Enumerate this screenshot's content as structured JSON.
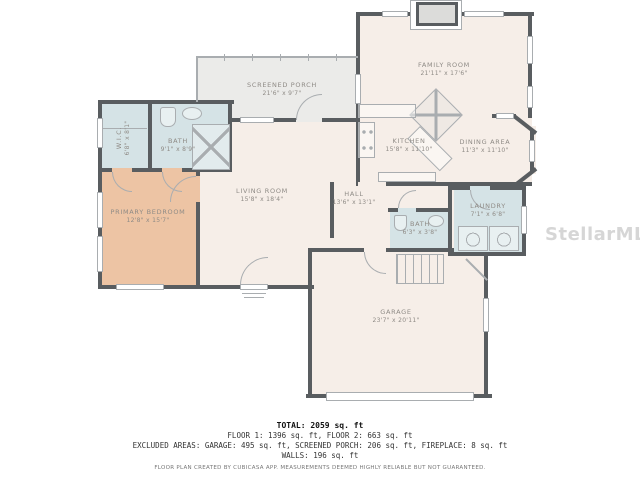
{
  "watermark": "StellarMLS",
  "colors": {
    "wall": "#595d60",
    "floor": "#f6eee8",
    "porch": "#ebebe9",
    "wet": "#d5e3e6",
    "bedroom": "#edc4a4",
    "label": "#8f8b86",
    "line": "#a9adb0",
    "ftext": "#333333",
    "wm": "#cccccc"
  },
  "rooms": {
    "family": {
      "name": "FAMILY ROOM",
      "dims": "21'11\" x 17'6\""
    },
    "porch": {
      "name": "SCREENED PORCH",
      "dims": "21'6\" x 9'7\""
    },
    "kitchen": {
      "name": "KITCHEN",
      "dims": "15'8\" x 11'10\""
    },
    "dining": {
      "name": "DINING AREA",
      "dims": "11'3\" x 11'10\""
    },
    "wic": {
      "name": "W.I.C.",
      "dims": "6'8\" x 8'1\""
    },
    "bath1": {
      "name": "BATH",
      "dims": "9'1\" x 8'9\""
    },
    "bedroom": {
      "name": "PRIMARY BEDROOM",
      "dims": "12'8\" x 15'7\""
    },
    "living": {
      "name": "LIVING ROOM",
      "dims": "15'8\" x 18'4\""
    },
    "hall": {
      "name": "HALL",
      "dims": "13'6\" x 13'1\""
    },
    "bath2": {
      "name": "BATH",
      "dims": "6'3\" x 3'8\""
    },
    "laundry": {
      "name": "LAUNDRY",
      "dims": "7'1\" x 6'8\""
    },
    "garage": {
      "name": "GARAGE",
      "dims": "23'7\" x 20'11\""
    }
  },
  "footer": {
    "total": "TOTAL: 2059 sq. ft",
    "floors": "FLOOR 1: 1396 sq. ft, FLOOR 2: 663 sq. ft",
    "excluded": "EXCLUDED AREAS: GARAGE: 495 sq. ft, SCREENED PORCH: 206 sq. ft, FIREPLACE: 8 sq. ft",
    "walls": "WALLS: 196 sq. ft",
    "disclaimer": "FLOOR PLAN CREATED BY CUBICASA APP. MEASUREMENTS DEEMED HIGHLY RELIABLE BUT NOT GUARANTEED."
  }
}
